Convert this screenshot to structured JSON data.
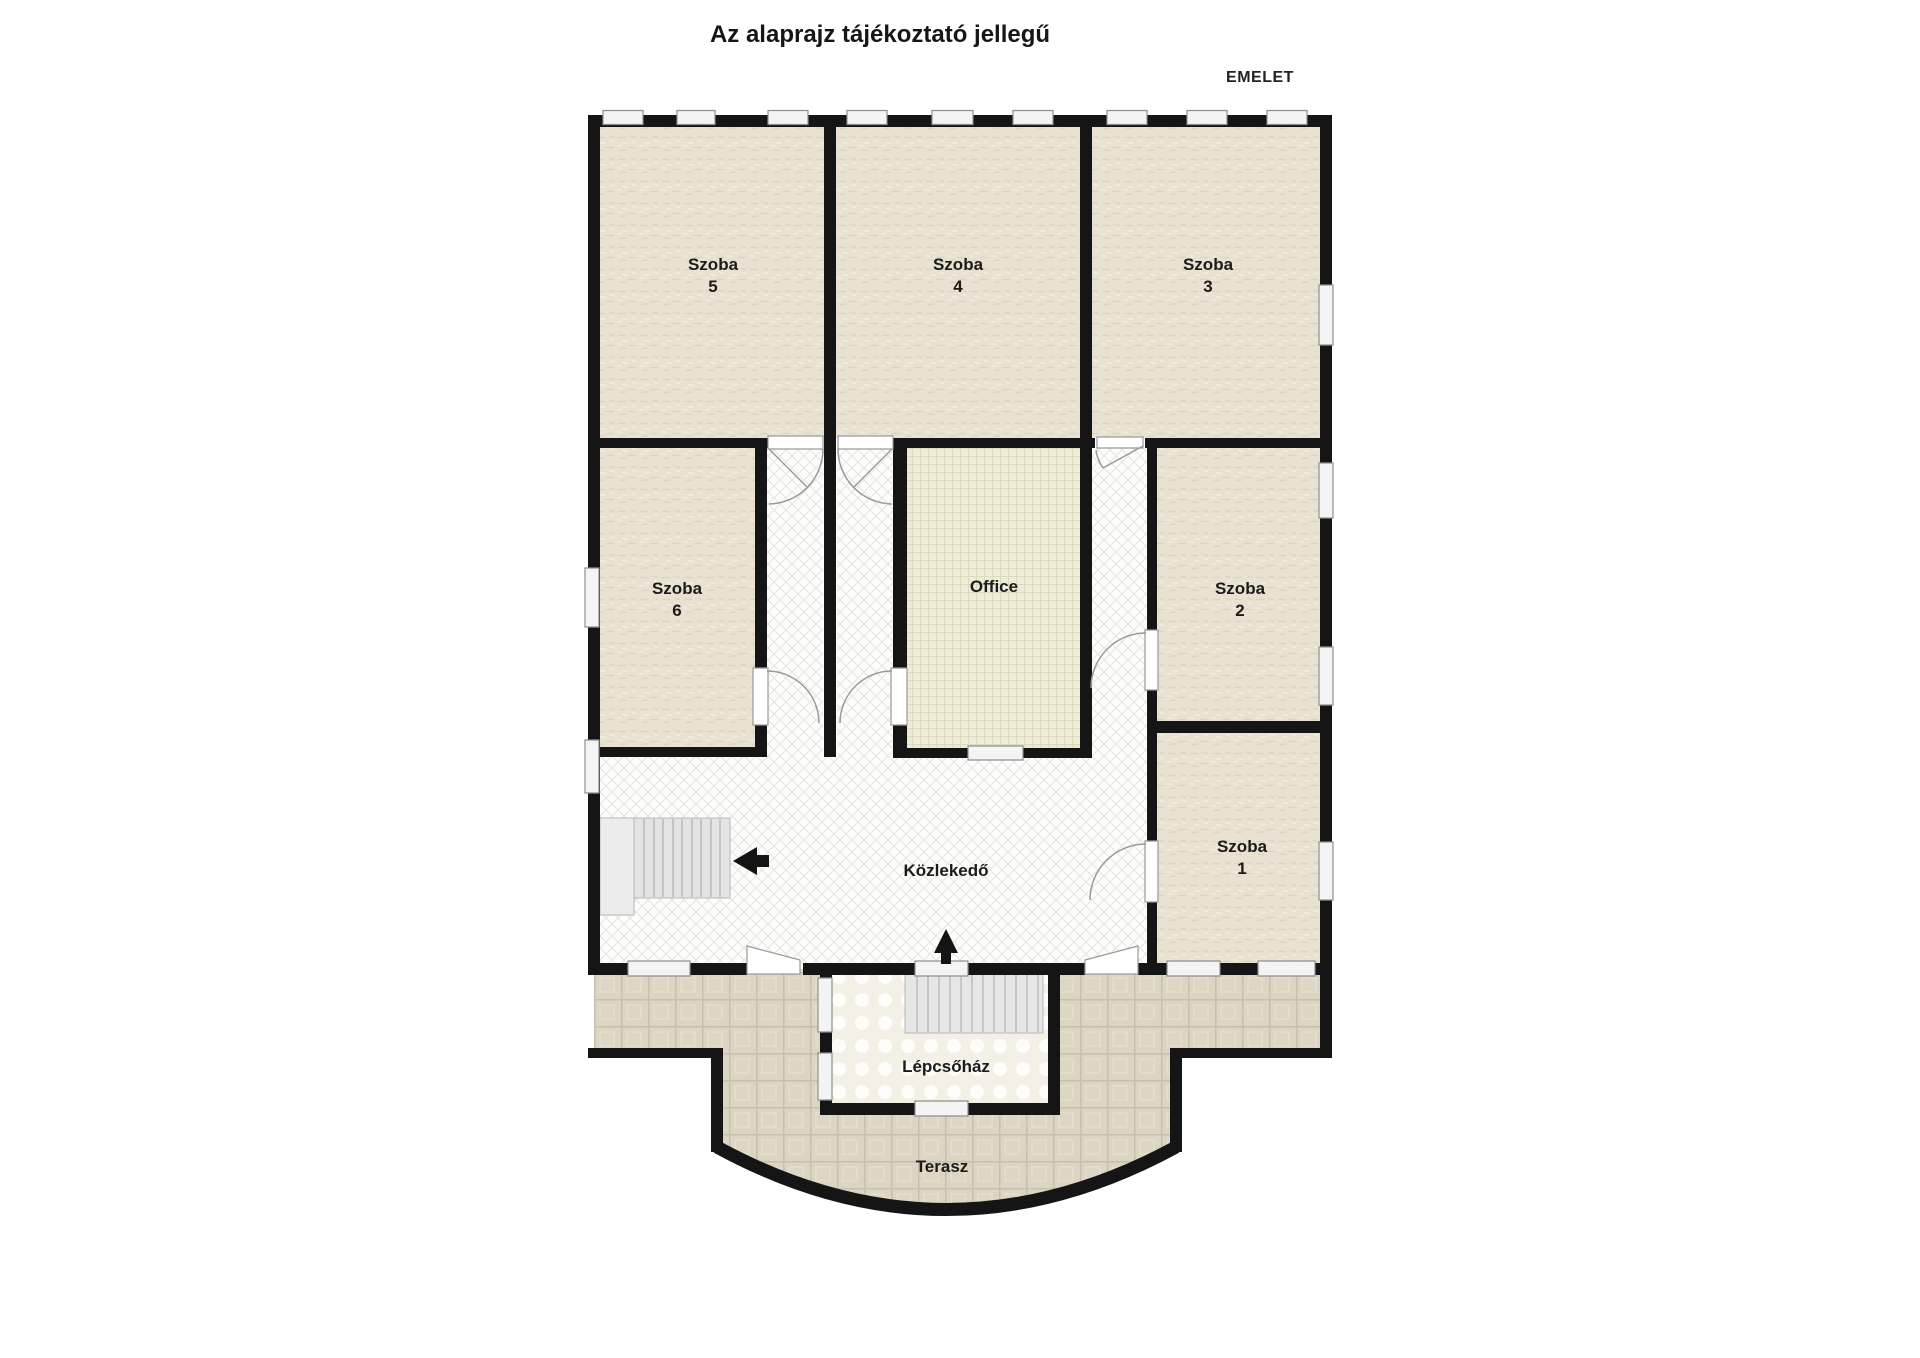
{
  "title": "Az alaprajz tájékoztató jellegű",
  "floor_label": "EMELET",
  "rooms": {
    "szoba5": {
      "label": "Szoba",
      "number": "5"
    },
    "szoba4": {
      "label": "Szoba",
      "number": "4"
    },
    "szoba3": {
      "label": "Szoba",
      "number": "3"
    },
    "szoba6": {
      "label": "Szoba",
      "number": "6"
    },
    "szoba2": {
      "label": "Szoba",
      "number": "2"
    },
    "szoba1": {
      "label": "Szoba",
      "number": "1"
    },
    "office": {
      "label": "Office"
    },
    "kozlekedo": {
      "label": "Közlekedő"
    },
    "lepcsohaz": {
      "label": "Lépcsőház"
    },
    "terasz": {
      "label": "Terasz"
    }
  },
  "colors": {
    "wall": "#151515",
    "room_floor": "#e9e2d2",
    "office_floor": "#eeecd9",
    "hall_floor": "#fdfdfc",
    "terrace_floor": "#dcd5c3",
    "stairwell_floor": "#f4f0e5",
    "window_fill": "#f4f4f4",
    "window_stroke": "#8f8f8f"
  }
}
